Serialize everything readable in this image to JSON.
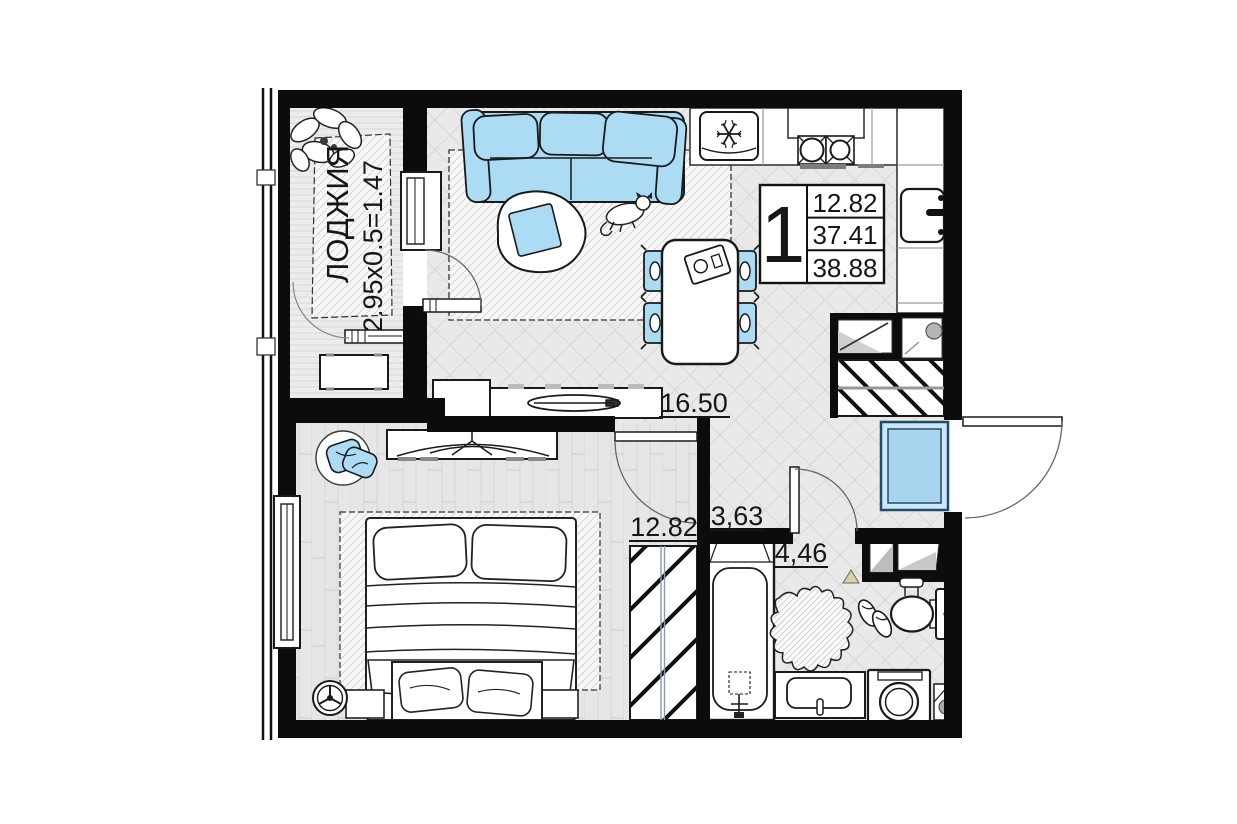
{
  "info": {
    "room_count": "1",
    "rows": [
      "12.82",
      "37.41",
      "38.88"
    ]
  },
  "labels": {
    "loggia_name": "ЛОДЖИЯ",
    "loggia_dims": "2.95x0.5=1.47",
    "living": "16.50",
    "bedroom": "12.82",
    "hallway": "3,63",
    "bathroom": "4,46"
  },
  "colors": {
    "wall": "#0c0c0c",
    "accent_blue": "#abdcf4",
    "floor_gray": "#e9e9e9",
    "hatch_gray": "#d8d8d8"
  },
  "icons": {
    "kitchen": [
      "fridge-icon",
      "stove-icon",
      "kitchen-sink-icon"
    ],
    "living": [
      "sofa-icon",
      "coffee-table-icon",
      "cat-icon",
      "dining-table-icon",
      "chair-icon",
      "tv-console-icon"
    ],
    "bedroom": [
      "bed-icon",
      "wardrobe-icon",
      "clock-icon",
      "chair-clothes-icon",
      "tv-stand-icon"
    ],
    "bathroom": [
      "bathtub-icon",
      "toilet-icon",
      "vanity-sink-icon",
      "washing-machine-icon",
      "animal-skin-rug-icon",
      "slippers-icon"
    ],
    "loggia": [
      "plant-icon",
      "bench-icon"
    ],
    "hallway": [
      "entrance-mat-icon",
      "hall-wardrobe-icon",
      "entrance-door-icon"
    ]
  }
}
